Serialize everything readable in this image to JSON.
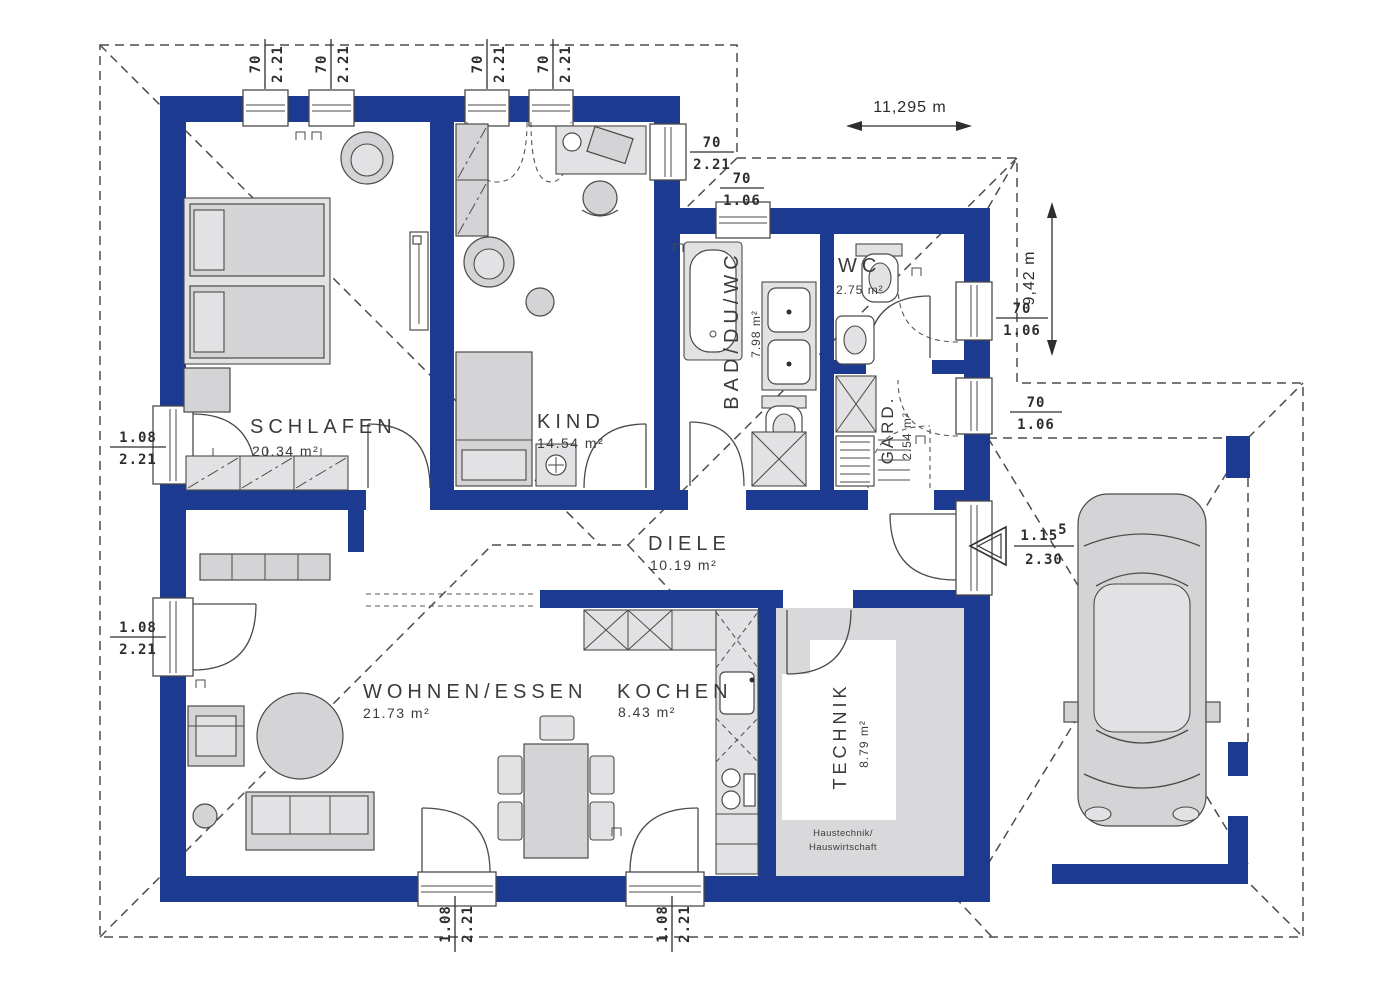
{
  "plan": {
    "rooms": {
      "schlafen": {
        "name": "SCHLAFEN",
        "area": "20.34 m²"
      },
      "kind": {
        "name": "KIND",
        "area": "14.54 m²"
      },
      "bad": {
        "name": "BAD/DU/WC",
        "area": "7.98 m²"
      },
      "wc": {
        "name": "WC",
        "area": "2.75 m²"
      },
      "gard": {
        "name": "GARD.",
        "area": "2.54 m²"
      },
      "diele": {
        "name": "DIELE",
        "area": "10.19 m²"
      },
      "wohnen": {
        "name": "WOHNEN/ESSEN",
        "area": "21.73 m²"
      },
      "kochen": {
        "name": "KOCHEN",
        "area": "8.43 m²"
      },
      "technik": {
        "name": "TECHNIK",
        "area": "8.79 m²",
        "note1": "Haustechnik/",
        "note2": "Hauswirtschaft"
      }
    },
    "dims": {
      "window_small": {
        "w": "70",
        "h": "2.21"
      },
      "window_low": {
        "w": "70",
        "h": "1.06"
      },
      "terrace_door": {
        "w": "1.08",
        "h": "2.21"
      },
      "entrance_door": {
        "w": "1.15",
        "sup": "5",
        "h": "2.30"
      }
    },
    "overall": {
      "width": "11,295 m",
      "height": "9,42 m"
    },
    "colors": {
      "wall": "#1c3b90",
      "furniture": "#d4d4d6",
      "outline": "#4a4a4a",
      "text": "#3b3b3b"
    }
  }
}
